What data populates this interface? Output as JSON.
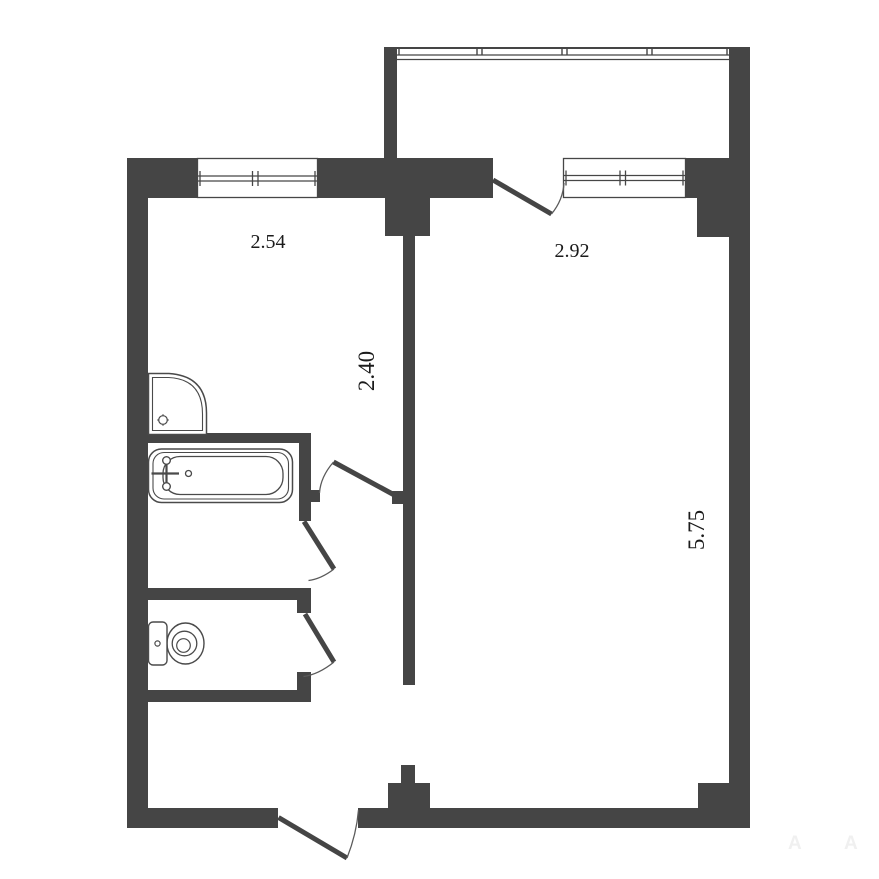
{
  "floorplan": {
    "type": "apartment-floor-plan",
    "units": "m",
    "labels": {
      "kitchen_width": "2.54",
      "kitchen_depth": "2.40",
      "living_width": "2.92",
      "living_depth": "5.75"
    },
    "fixtures": [
      "shower-cabin-icon",
      "bathtub-icon",
      "toilet-icon"
    ],
    "features": [
      "balcony-glazing",
      "balcony-door",
      "kitchen-window",
      "living-room-window",
      "bathroom-door",
      "toilet-door",
      "kitchen-door",
      "entrance-door"
    ],
    "watermark": {
      "letters": [
        "A",
        "A"
      ]
    },
    "colors": {
      "wall": "#454545",
      "outline": "#4a4a4a",
      "arc": "#5a5a5a",
      "text": "#1b1b1b",
      "watermark": "#f0f0f0",
      "background": "#ffffff"
    }
  }
}
